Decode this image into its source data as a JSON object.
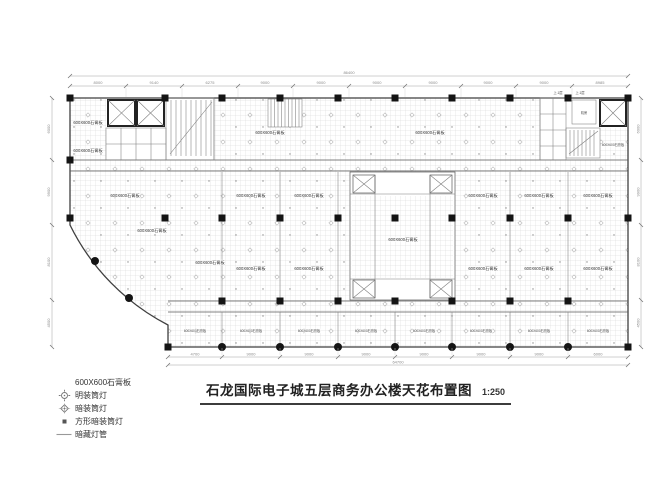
{
  "title": {
    "text": "石龙国际电子城五层商务办公楼天花布置图",
    "scale": "1:250"
  },
  "legend": {
    "items": [
      {
        "symbol": "gypsum-board",
        "label": "600X600石膏板"
      },
      {
        "symbol": "surface-downlight",
        "label": "明装筒灯"
      },
      {
        "symbol": "recessed-downlight",
        "label": "暗装筒灯"
      },
      {
        "symbol": "square-recessed-downlight",
        "label": "方形暗装筒灯"
      },
      {
        "symbol": "concealed-light-tube",
        "label": "暗藏灯管"
      }
    ]
  },
  "plan": {
    "tile_label": "600X600石膏板",
    "stair_up_label": "上.1层",
    "machine_room_label": "机房",
    "dimensions": {
      "top_total": "86400",
      "top_segments": [
        "8000",
        "9140",
        "6275",
        "9000",
        "9000",
        "9000",
        "9000",
        "9000",
        "9000",
        "8985"
      ],
      "bottom_total": "64700",
      "bottom_segments": [
        "4700",
        "9000",
        "9000",
        "9000",
        "9000",
        "9000",
        "9000",
        "6000"
      ],
      "left_segments": [
        "6000",
        "9900",
        "8100",
        "4500"
      ],
      "right_segments": [
        "6000",
        "9900",
        "8100",
        "4500"
      ]
    }
  }
}
